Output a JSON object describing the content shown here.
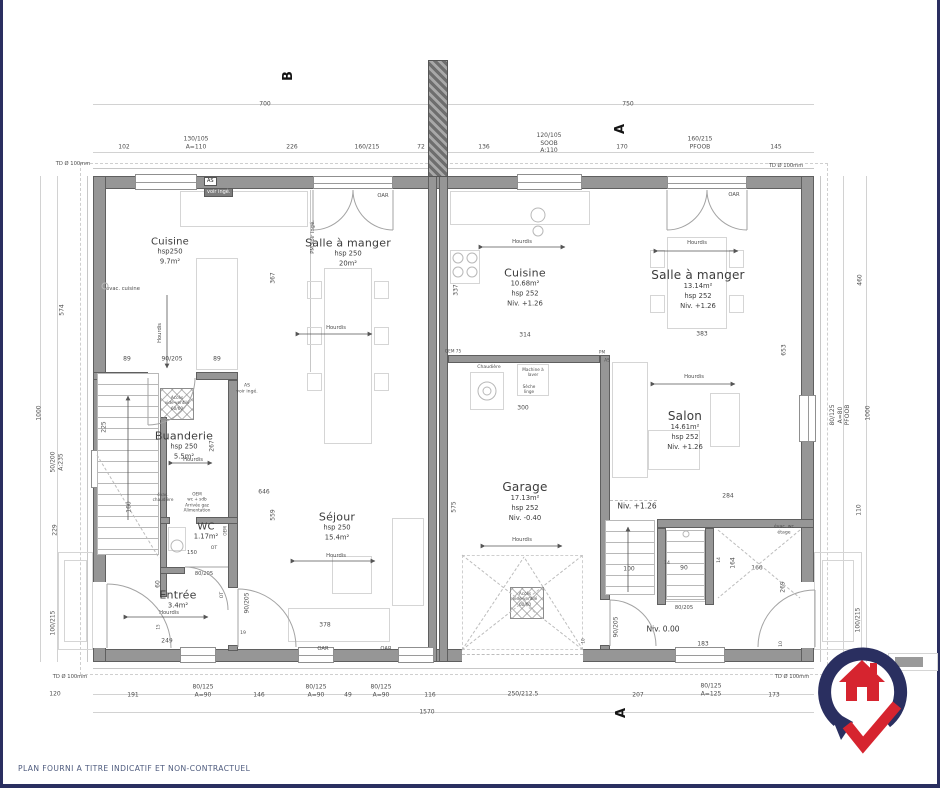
{
  "footer": {
    "disclaimer": "PLAN FOURNI A TITRE INDICATIF ET NON-CONTRACTUEL"
  },
  "markers": {
    "b_top": "B",
    "a_top": "A",
    "a_bottom": "A"
  },
  "colors": {
    "navy": "#2a2f60",
    "red": "#d6242f",
    "wall": "#969696",
    "dim_text": "#4c4c4c"
  },
  "rooms": {
    "cuisine_l": {
      "name": "Cuisine",
      "l1": "hsp250",
      "l2": "9.7m²"
    },
    "salle_l": {
      "name": "Salle à manger",
      "l1": "hsp 250",
      "l2": "20m²"
    },
    "buanderie": {
      "name": "Buanderie",
      "l1": "hsp 250",
      "l2": "5.5m²"
    },
    "wc": {
      "name": "WC",
      "l1": "1.17m²"
    },
    "entree": {
      "name": "Entrée",
      "l1": "3.4m²"
    },
    "sejour": {
      "name": "Séjour",
      "l1": "hsp 250",
      "l2": "15.4m²"
    },
    "cuisine_r": {
      "name": "Cuisine",
      "l1": "10.68m²",
      "l2": "hsp 252",
      "l3": "Niv. +1.26"
    },
    "salle_r": {
      "name": "Salle à manger",
      "l1": "13.14m²",
      "l2": "hsp 252",
      "l3": "Niv. +1.26"
    },
    "salon": {
      "name": "Salon",
      "l1": "14.61m²",
      "l2": "hsp 252",
      "l3": "Niv. +1.26"
    },
    "garage": {
      "name": "Garage",
      "l1": "17.13m²",
      "l2": "hsp 252",
      "l3": "Niv. -0.40"
    }
  },
  "ann": {
    "d700": "700",
    "d750": "750",
    "t102": "102",
    "t130": "130/105\nA=110",
    "t226": "226",
    "t160": "160/215",
    "t72": "72",
    "t136": "136",
    "t120": "120/105\nSOOB\nA:110",
    "t170": "170",
    "t160p": "160/215\nPFOOB",
    "t145": "145",
    "td_tl": "TD Ø 100mm",
    "td_tr": "TD Ø 100mm",
    "td_bl": "TD Ø 100mm",
    "td_br": "TD Ø 100mm",
    "l574": "574",
    "l1000": "1000",
    "l50200": "50/200\nA:235",
    "l229": "229",
    "l100215": "100/215",
    "l120": "120",
    "r460": "460",
    "r80125": "80/125\nA=80\nPFOOB",
    "r1000": "1000",
    "r110": "110",
    "r100215": "100/215",
    "b191": "191",
    "b80a": "80/125\nA=90",
    "b146": "146",
    "b80b": "80/125\nA=90",
    "b49": "49",
    "b80c": "80/125\nA=90",
    "b116": "116",
    "b1570": "1570",
    "b250": "250/212.5",
    "b207": "207",
    "b80d": "80/125\nA=125",
    "b173": "173",
    "as1": "AS",
    "vi1": "voir ingé.",
    "pm1": "PM voir ingé.",
    "evc": "évac. cuisine",
    "h1": "Hourdis",
    "d89a": "89",
    "d90205a": "90/205",
    "d89b": "89",
    "d367": "367",
    "oar1": "OAR",
    "h2": "Hourdis",
    "d337": "337",
    "acc1": "Accès\nvide-ventilé\n60/60",
    "d225": "225",
    "d267": "267",
    "h3": "Hourdis",
    "oem1": "OEM\nwc + sdb\nArrivée gaz\nAlimentation",
    "evch": "évac.\nchaudière",
    "oemv": "OEM",
    "d150": "150",
    "ot1": "OT",
    "d80205a": "80/205",
    "d646": "646",
    "d559": "559",
    "d160": "160",
    "d60": "60",
    "h4": "Hourdis",
    "d249": "249",
    "ot2": "OT",
    "d90205b": "90/205",
    "d19": "19",
    "d15": "15",
    "h5": "Hourdis",
    "d378": "378",
    "oar2": "OAR",
    "oar3": "OAR",
    "d575": "575",
    "as2": "AS\nvoir ingé.",
    "h6": "Hourdis",
    "d314": "314",
    "oem75": "OEM 75",
    "pm2": "PM",
    "as3": "AS",
    "chaud": "Chaudière",
    "ml": "Machine à\nlaver",
    "sl": "Sèche\nlinge",
    "d300": "300",
    "h7": "Hourdis",
    "oar4": "OAR",
    "d383": "383",
    "d653": "653",
    "h8": "Hourdis",
    "d284": "284",
    "niv126": "Niv. +1.26",
    "evwc": "évac. wc\nétage",
    "d100": "100",
    "d14a": "14",
    "d90": "90",
    "d14b": "14",
    "d164": "164",
    "d166": "166",
    "d269": "269",
    "d80205b": "80/205",
    "niv0": "Niv. 0.00",
    "d183": "183",
    "d10a": "10",
    "d90205c": "90/205",
    "d10b": "10",
    "acc2": "Accès\nvide-ventilé\n60/60",
    "h9": "Hourdis"
  }
}
